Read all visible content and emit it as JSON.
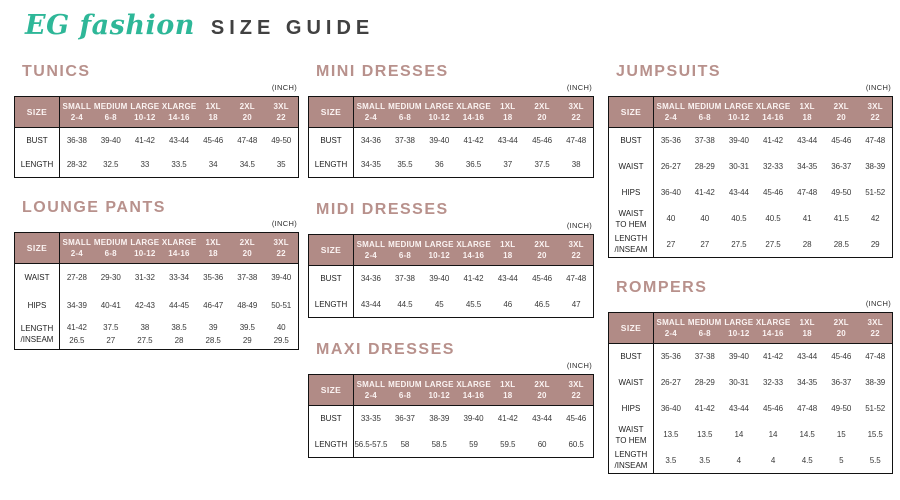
{
  "brand": {
    "logo": "EG fashion",
    "title": "SIZE GUIDE"
  },
  "colors": {
    "brand_teal": "#2eb798",
    "heading_rose": "#b8918c",
    "table_header_bg": "#b18b86",
    "border": "#121212",
    "body_text": "#3a3a3a"
  },
  "tables": [
    {
      "id": "tunics",
      "title": "TUNICS",
      "unit": "(INCH)",
      "size_label": "SIZE",
      "columns": [
        {
          "label": "SMALL",
          "sub": "2-4"
        },
        {
          "label": "MEDIUM",
          "sub": "6-8"
        },
        {
          "label": "LARGE",
          "sub": "10-12"
        },
        {
          "label": "XLARGE",
          "sub": "14-16"
        },
        {
          "label": "1XL",
          "sub": "18"
        },
        {
          "label": "2XL",
          "sub": "20"
        },
        {
          "label": "3XL",
          "sub": "22"
        }
      ],
      "rows": [
        {
          "label": "BUST",
          "values": [
            "36-38",
            "39-40",
            "41-42",
            "43-44",
            "45-46",
            "47-48",
            "49-50"
          ]
        },
        {
          "label": "LENGTH",
          "values": [
            "28-32",
            "32.5",
            "33",
            "33.5",
            "34",
            "34.5",
            "35"
          ]
        }
      ]
    },
    {
      "id": "lounge-pants",
      "title": "LOUNGE PANTS",
      "unit": "(INCH)",
      "size_label": "SIZE",
      "columns": [
        {
          "label": "SMALL",
          "sub": "2-4"
        },
        {
          "label": "MEDIUM",
          "sub": "6-8"
        },
        {
          "label": "LARGE",
          "sub": "10-12"
        },
        {
          "label": "XLARGE",
          "sub": "14-16"
        },
        {
          "label": "1XL",
          "sub": "18"
        },
        {
          "label": "2XL",
          "sub": "20"
        },
        {
          "label": "3XL",
          "sub": "22"
        }
      ],
      "rows": [
        {
          "label": "WAIST",
          "values": [
            "27-28",
            "29-30",
            "31-32",
            "33-34",
            "35-36",
            "37-38",
            "39-40"
          ]
        },
        {
          "label": "HIPS",
          "values": [
            "34-39",
            "40-41",
            "42-43",
            "44-45",
            "46-47",
            "48-49",
            "50-51"
          ]
        },
        {
          "label": "LENGTH\n/INSEAM",
          "values": [
            "41-42\n26.5",
            "37.5\n27",
            "38\n27.5",
            "38.5\n28",
            "39\n28.5",
            "39.5\n29",
            "40\n29.5"
          ]
        }
      ]
    },
    {
      "id": "mini-dresses",
      "title": "MINI DRESSES",
      "unit": "(INCH)",
      "size_label": "SIZE",
      "columns": [
        {
          "label": "SMALL",
          "sub": "2-4"
        },
        {
          "label": "MEDIUM",
          "sub": "6-8"
        },
        {
          "label": "LARGE",
          "sub": "10-12"
        },
        {
          "label": "XLARGE",
          "sub": "14-16"
        },
        {
          "label": "1XL",
          "sub": "18"
        },
        {
          "label": "2XL",
          "sub": "20"
        },
        {
          "label": "3XL",
          "sub": "22"
        }
      ],
      "rows": [
        {
          "label": "BUST",
          "values": [
            "34-36",
            "37-38",
            "39-40",
            "41-42",
            "43-44",
            "45-46",
            "47-48"
          ]
        },
        {
          "label": "LENGTH",
          "values": [
            "34-35",
            "35.5",
            "36",
            "36.5",
            "37",
            "37.5",
            "38"
          ]
        }
      ]
    },
    {
      "id": "midi-dresses",
      "title": "MIDI DRESSES",
      "unit": "(INCH)",
      "size_label": "SIZE",
      "columns": [
        {
          "label": "SMALL",
          "sub": "2-4"
        },
        {
          "label": "MEDIUM",
          "sub": "6-8"
        },
        {
          "label": "LARGE",
          "sub": "10-12"
        },
        {
          "label": "XLARGE",
          "sub": "14-16"
        },
        {
          "label": "1XL",
          "sub": "18"
        },
        {
          "label": "2XL",
          "sub": "20"
        },
        {
          "label": "3XL",
          "sub": "22"
        }
      ],
      "rows": [
        {
          "label": "BUST",
          "values": [
            "34-36",
            "37-38",
            "39-40",
            "41-42",
            "43-44",
            "45-46",
            "47-48"
          ]
        },
        {
          "label": "LENGTH",
          "values": [
            "43-44",
            "44.5",
            "45",
            "45.5",
            "46",
            "46.5",
            "47"
          ]
        }
      ]
    },
    {
      "id": "maxi-dresses",
      "title": "MAXI DRESSES",
      "unit": "(INCH)",
      "size_label": "SIZE",
      "columns": [
        {
          "label": "SMALL",
          "sub": "2-4"
        },
        {
          "label": "MEDIUM",
          "sub": "6-8"
        },
        {
          "label": "LARGE",
          "sub": "10-12"
        },
        {
          "label": "XLARGE",
          "sub": "14-16"
        },
        {
          "label": "1XL",
          "sub": "18"
        },
        {
          "label": "2XL",
          "sub": "20"
        },
        {
          "label": "3XL",
          "sub": "22"
        }
      ],
      "rows": [
        {
          "label": "BUST",
          "values": [
            "33-35",
            "36-37",
            "38-39",
            "39-40",
            "41-42",
            "43-44",
            "45-46"
          ]
        },
        {
          "label": "LENGTH",
          "values": [
            "56.5-57.5",
            "58",
            "58.5",
            "59",
            "59.5",
            "60",
            "60.5"
          ]
        }
      ]
    },
    {
      "id": "jumpsuits",
      "title": "JUMPSUITS",
      "unit": "(INCH)",
      "size_label": "SIZE",
      "columns": [
        {
          "label": "SMALL",
          "sub": "2-4"
        },
        {
          "label": "MEDIUM",
          "sub": "6-8"
        },
        {
          "label": "LARGE",
          "sub": "10-12"
        },
        {
          "label": "XLARGE",
          "sub": "14-16"
        },
        {
          "label": "1XL",
          "sub": "18"
        },
        {
          "label": "2XL",
          "sub": "20"
        },
        {
          "label": "3XL",
          "sub": "22"
        }
      ],
      "rows": [
        {
          "label": "BUST",
          "values": [
            "35-36",
            "37-38",
            "39-40",
            "41-42",
            "43-44",
            "45-46",
            "47-48"
          ]
        },
        {
          "label": "WAIST",
          "values": [
            "26-27",
            "28-29",
            "30-31",
            "32-33",
            "34-35",
            "36-37",
            "38-39"
          ]
        },
        {
          "label": "HIPS",
          "values": [
            "36-40",
            "41-42",
            "43-44",
            "45-46",
            "47-48",
            "49-50",
            "51-52"
          ]
        },
        {
          "label": "WAIST\nTO HEM",
          "values": [
            "40",
            "40",
            "40.5",
            "40.5",
            "41",
            "41.5",
            "42"
          ]
        },
        {
          "label": "LENGTH\n/INSEAM",
          "values": [
            "27",
            "27",
            "27.5",
            "27.5",
            "28",
            "28.5",
            "29"
          ]
        }
      ]
    },
    {
      "id": "rompers",
      "title": "ROMPERS",
      "unit": "(INCH)",
      "size_label": "SIZE",
      "columns": [
        {
          "label": "SMALL",
          "sub": "2-4"
        },
        {
          "label": "MEDIUM",
          "sub": "6-8"
        },
        {
          "label": "LARGE",
          "sub": "10-12"
        },
        {
          "label": "XLARGE",
          "sub": "14-16"
        },
        {
          "label": "1XL",
          "sub": "18"
        },
        {
          "label": "2XL",
          "sub": "20"
        },
        {
          "label": "3XL",
          "sub": "22"
        }
      ],
      "rows": [
        {
          "label": "BUST",
          "values": [
            "35-36",
            "37-38",
            "39-40",
            "41-42",
            "43-44",
            "45-46",
            "47-48"
          ]
        },
        {
          "label": "WAIST",
          "values": [
            "26-27",
            "28-29",
            "30-31",
            "32-33",
            "34-35",
            "36-37",
            "38-39"
          ]
        },
        {
          "label": "HIPS",
          "values": [
            "36-40",
            "41-42",
            "43-44",
            "45-46",
            "47-48",
            "49-50",
            "51-52"
          ]
        },
        {
          "label": "WAIST\nTO HEM",
          "values": [
            "13.5",
            "13.5",
            "14",
            "14",
            "14.5",
            "15",
            "15.5"
          ]
        },
        {
          "label": "LENGTH\n/INSEAM",
          "values": [
            "3.5",
            "3.5",
            "4",
            "4",
            "4.5",
            "5",
            "5.5"
          ]
        }
      ]
    }
  ]
}
